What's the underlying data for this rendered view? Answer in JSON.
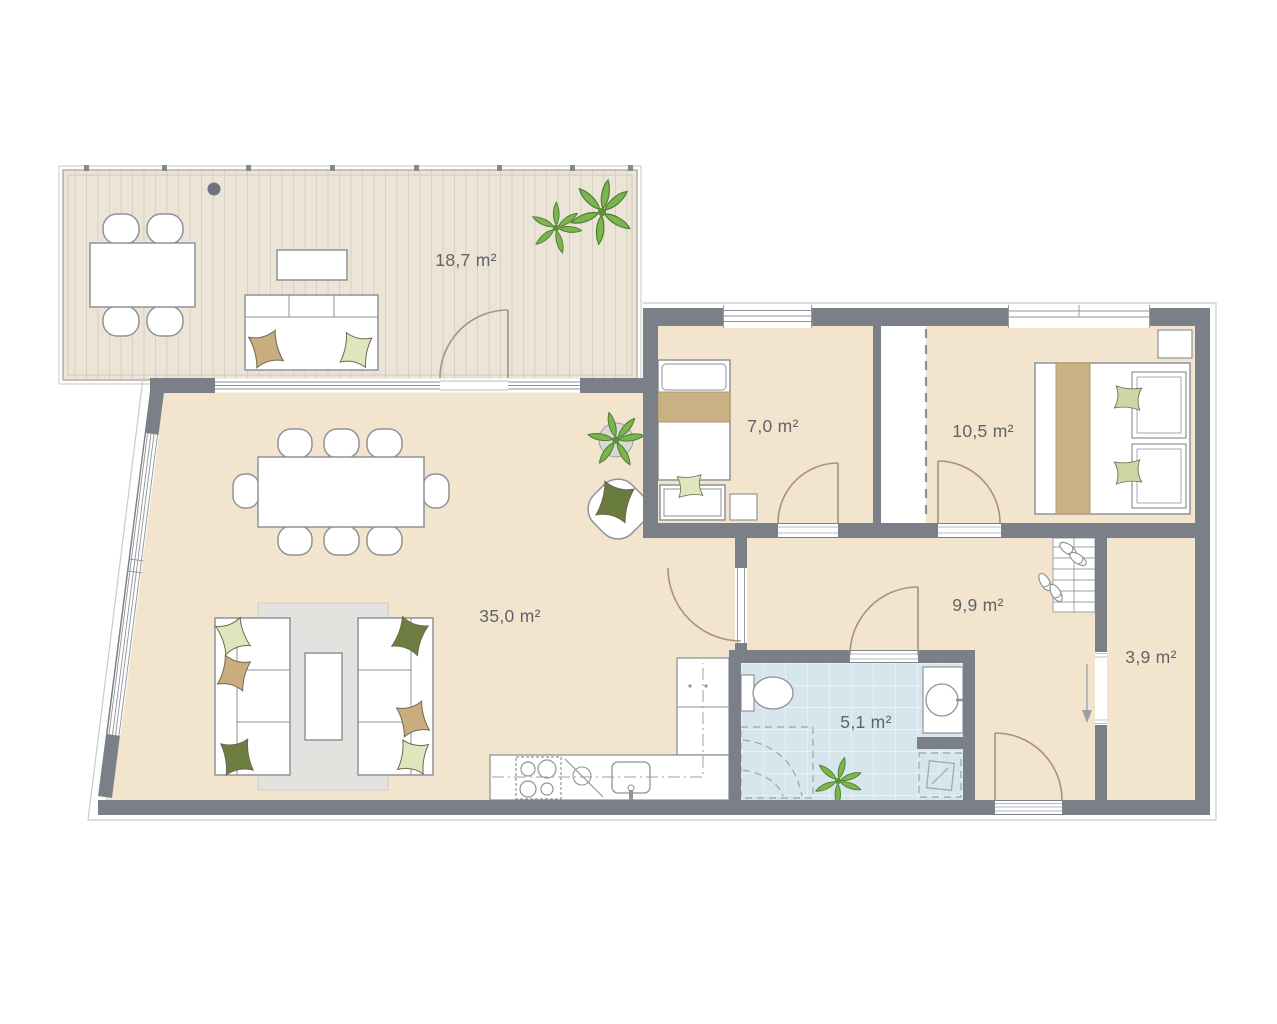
{
  "title": "apartment-floor-plan",
  "unit": "m²",
  "rooms": [
    {
      "id": "terrace",
      "area": "18,7 m²"
    },
    {
      "id": "living-dining",
      "area": "35,0 m²"
    },
    {
      "id": "bedroom-1",
      "area": "7,0 m²"
    },
    {
      "id": "bedroom-2",
      "area": "10,5 m²"
    },
    {
      "id": "hallway",
      "area": "9,9 m²"
    },
    {
      "id": "bathroom",
      "area": "5,1 m²"
    },
    {
      "id": "storage",
      "area": "3,9 m²"
    }
  ],
  "colors": {
    "wall": "#7a7f88",
    "floor": "#f3e4cd",
    "terrace_deck": "#ece4d6",
    "terrace_plank_line": "#d9d0c0",
    "bath_tile": "#d6e6ec",
    "rug": "#e4e2df",
    "accent_tan": "#c9ad7e",
    "accent_light_green": "#dfe5bc",
    "accent_sage": "#cdd6a4",
    "accent_dark_green": "#6d7d40",
    "plant_green": "#7cb450",
    "door_arc": "#a5937d",
    "fixture_stroke": "#8e939a",
    "label_text": "#606368"
  }
}
